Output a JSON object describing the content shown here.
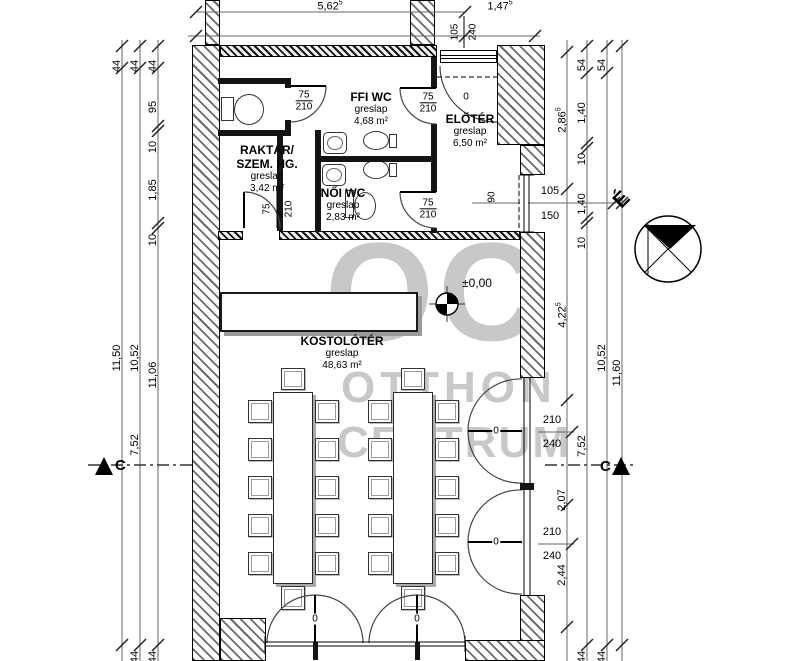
{
  "watermark": {
    "logo": "OC",
    "brand_line1": "OTTHON",
    "brand_line2": "CENTRUM"
  },
  "compass": {
    "north": "É"
  },
  "section": {
    "label": "C"
  },
  "level": {
    "label": "±0,00"
  },
  "rooms": {
    "kostoloter": {
      "name": "KOSTOLÓTÉR",
      "finish": "greslap",
      "area": "48,63 m²"
    },
    "eloter": {
      "name": "ELŐTÉR",
      "finish": "greslap",
      "area": "6,50 m²"
    },
    "ffi_wc": {
      "name": "FFI WC",
      "finish": "greslap",
      "area": "4,68 m²"
    },
    "noi_wc": {
      "name": "NŐI WC",
      "finish": "greslap",
      "area": "2,83 m²"
    },
    "raktar": {
      "name1": "RAKTÁR/",
      "name2": "SZEM. HG.",
      "finish": "greslap",
      "area": "3,42 m²"
    }
  },
  "openings": {
    "wc_door_w": "75",
    "wc_door_h": "210",
    "zero": "0",
    "entry_w": "105",
    "entry_h": "240",
    "window_w": "105",
    "window_h": "150",
    "sill": "90",
    "glass_door_w": "210",
    "glass_door_h": "240"
  },
  "dims": {
    "d44": "44",
    "d95": "95",
    "d10": "10",
    "d185": "1,85",
    "d1150": "11,50",
    "d1052": "10,52",
    "d1106": "11,06",
    "d752": "7,52",
    "d54": "54",
    "d140": "1,40",
    "d207": "2,07",
    "d244": "2,44",
    "d1160": "11,60",
    "d286": "2,86",
    "d422": "4,22",
    "d562": "5,62",
    "d147": "1,47",
    "sup5": "5"
  }
}
